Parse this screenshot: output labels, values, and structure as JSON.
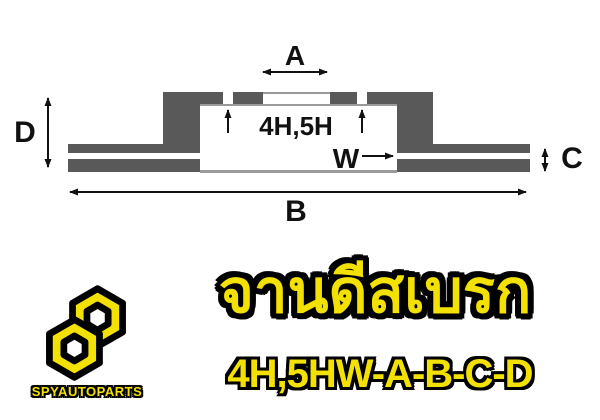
{
  "diagram": {
    "dim_a": "A",
    "dim_b": "B",
    "dim_c": "C",
    "dim_d": "D",
    "dim_w": "W",
    "bolt_pattern": "4H,5H",
    "colors": {
      "metal": "#595959",
      "line": "#111111",
      "edge": "#9a9a9a"
    }
  },
  "footer": {
    "brand": "SPYAUTOPARTS",
    "title": "จานดีสเบรก",
    "spec_code": "4H,5HW-A-B-C-D",
    "colors": {
      "yellow": "#f3e103",
      "outline": "#000000"
    }
  }
}
